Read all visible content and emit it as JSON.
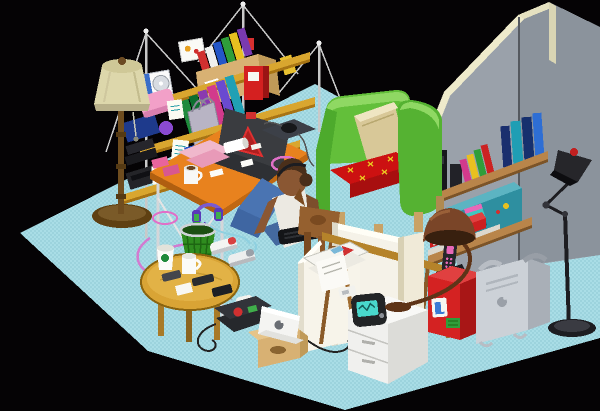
{
  "meta": {
    "title": "Isometric pixel-art room illustration",
    "style": "pixel art, isometric view, black background"
  },
  "colors": {
    "background": "#050305",
    "floor": "#a9dde6",
    "floor_dither": "#9cd3dd",
    "wall_front": "#9aa1aa",
    "wall_right": "#8b939c",
    "wall_trim": "#eeeacb",
    "shelf_wood": "#d9a62f",
    "shelf_wood_edge": "#a87414",
    "wall_shelf_wood": "#b9854a",
    "desk_top": "#e8821e",
    "desk_edge": "#b05f10",
    "metal_leg": "#d4d6d9",
    "chair_green": "#63bf3a",
    "chair_green_dark": "#4daa2c",
    "chair_green_light": "#8fd863",
    "chair_cushion": "#cc1111",
    "cushion_stitch": "#e8c020",
    "chair_pillow": "#d8c898",
    "lamp_shade": "#ddd7ab",
    "lamp_pole": "#6f4d1f",
    "table_wood": "#d9a435",
    "skin": "#8a5733",
    "hair": "#4a2f1a",
    "shirt": "#ece9e2",
    "jeans": "#4a74b2",
    "dog_brown": "#95602f",
    "dog_dark": "#7a4a20",
    "canvas_white": "#f5f2e8",
    "drawer_white": "#f0f0ee",
    "red_box": "#d42222",
    "powermac_gray": "#ccd1d7",
    "trash_green": "#2f8c1f",
    "laptop_dark": "#3a3c40",
    "logo_red": "#d03030",
    "cable_pink": "#d27bd0",
    "headphones_purple": "#7a5ad0",
    "boombox_teal": "#2e8fa0",
    "radio_screen": "#49d8cc",
    "cardboard": "#d8b173",
    "apple_laptop_white": "#f4f4f2",
    "bronze_lamp": "#7a4528",
    "black_lamp": "#26262a"
  },
  "scene": {
    "objects": [
      {
        "id": "floor",
        "desc": "cyan dithered isometric floor slab"
      },
      {
        "id": "gray-wall",
        "desc": "freestanding gray wall panels with cream trim, vertical seam"
      },
      {
        "id": "wall-shelves",
        "desc": "two wooden wall shelves with black speakers, colorful books, teal boombox, red box"
      },
      {
        "id": "anglepoise-lamp",
        "desc": "black articulated floor lamp with red cap, right wall"
      },
      {
        "id": "floor-lamp",
        "desc": "floor lamp with cream shade and brown pole, left"
      },
      {
        "id": "wire-shelf-unit",
        "desc": "three golden shelf boards hung from poles and guy wires, loaded with books, CD, pink box, cardboard book box, stereo, sticky notes"
      },
      {
        "id": "desk",
        "desc": "orange desk on metal legs: dark laptop with red triangle logo, mouse pad, pink papers, mugs, erasers"
      },
      {
        "id": "headphones",
        "desc": "purple headphones hanging under desk"
      },
      {
        "id": "power-strip",
        "desc": "white power strip with pink coiled cables"
      },
      {
        "id": "trash-can",
        "desc": "green wire mesh waste basket"
      },
      {
        "id": "person",
        "desc": "person sitting on floor, white tank top, blue jeans, dark hair bun, black laptop in front"
      },
      {
        "id": "dog",
        "desc": "brown dog sniffing floor beside person"
      },
      {
        "id": "armchair",
        "desc": "green armchair with red x-stitched cushion and tan pillow"
      },
      {
        "id": "coffee-table",
        "desc": "oval wooden coffee table with paper cup, mug, remotes and phones"
      },
      {
        "id": "sneakers",
        "desc": "pair of white sneakers"
      },
      {
        "id": "canvases",
        "desc": "two white boards leaning against wall"
      },
      {
        "id": "newspaper-rack",
        "desc": "wooden folding rack with newspapers"
      },
      {
        "id": "black-laptop-floor",
        "desc": "dark laptop with stickers on floor, cables, white mouse"
      },
      {
        "id": "apple-ibook",
        "desc": "white Apple laptop on cardboard box"
      },
      {
        "id": "drawer-unit",
        "desc": "white three-drawer unit with radio and bronze desk lamp on top"
      },
      {
        "id": "red-box-phone",
        "desc": "red cabinet with stickers and docked cordless phone"
      },
      {
        "id": "powermac-g4",
        "desc": "silver Power Mac G4 tower with handles and apple logo"
      },
      {
        "id": "floor-lamp-right",
        "desc": "black pole floor lamp, far right"
      }
    ]
  }
}
